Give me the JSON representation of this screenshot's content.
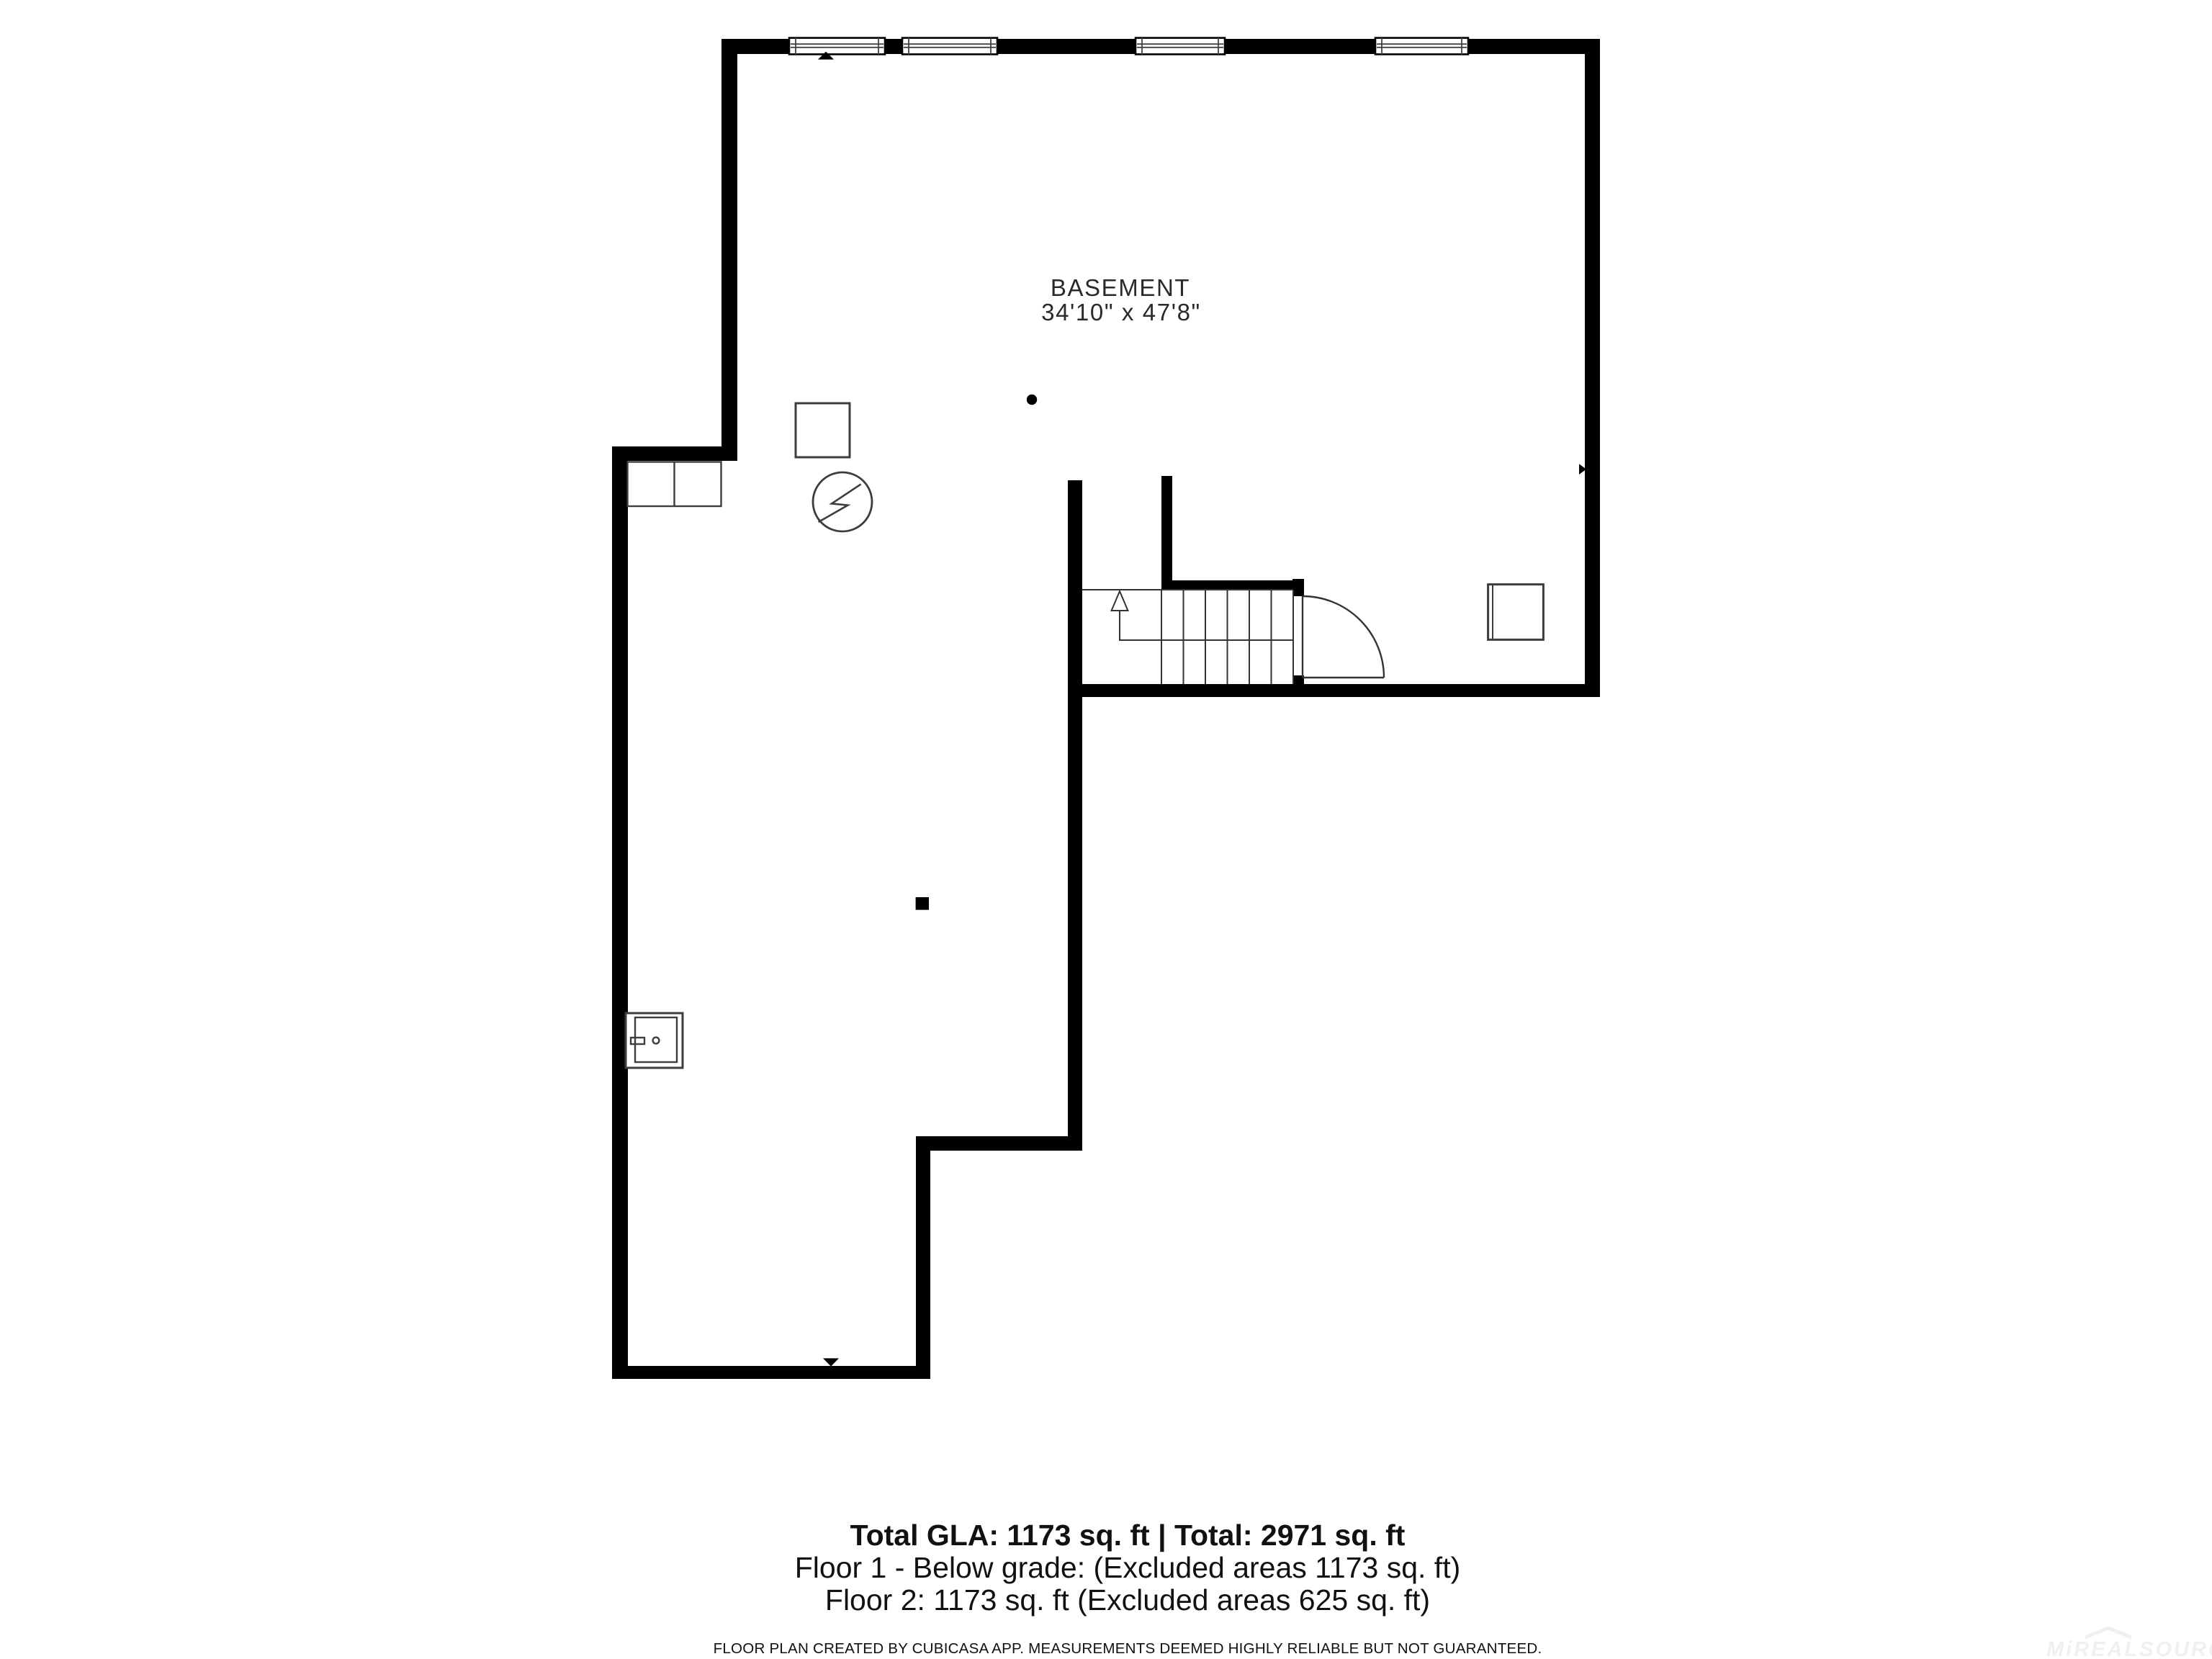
{
  "room": {
    "label": "BASEMENT",
    "dimensions": "34'10\" x 47'8\""
  },
  "summary": {
    "total_line": "Total GLA: 1173 sq. ft | Total: 2971 sq. ft",
    "floor1_line": "Floor 1 - Below grade: (Excluded areas 1173 sq. ft)",
    "floor2_line": "Floor 2: 1173 sq. ft (Excluded areas 625 sq. ft)"
  },
  "disclaimer": "FLOOR PLAN CREATED BY CUBICASA APP. MEASUREMENTS DEEMED HIGHLY RELIABLE BUT NOT GUARANTEED.",
  "watermark": "MiREALSOURCE",
  "stairs": {
    "treads": 6,
    "direction": "up"
  },
  "window_count": 4,
  "colors": {
    "wall": "#000000",
    "background": "#ffffff",
    "fixture_stroke": "#3d3d3d",
    "text": "#111111",
    "watermark": "#f0f0f0"
  },
  "icons": {
    "window-icon": "double-pane window bar",
    "stairs-icon": "treads with up-arrow walk line",
    "door-icon": "quarter-circle swing",
    "electric-meter-icon": "circle with lightning bolt",
    "furnace-icon": "square outline",
    "appliance-icon": "square with door line",
    "utility-appliance-icon": "box with inner box, plug and dial",
    "cabinet-icon": "double cabinet rectangle",
    "column-icon": "small filled dot",
    "post-icon": "small filled square",
    "wall-marker-icon": "small filled triangle"
  }
}
